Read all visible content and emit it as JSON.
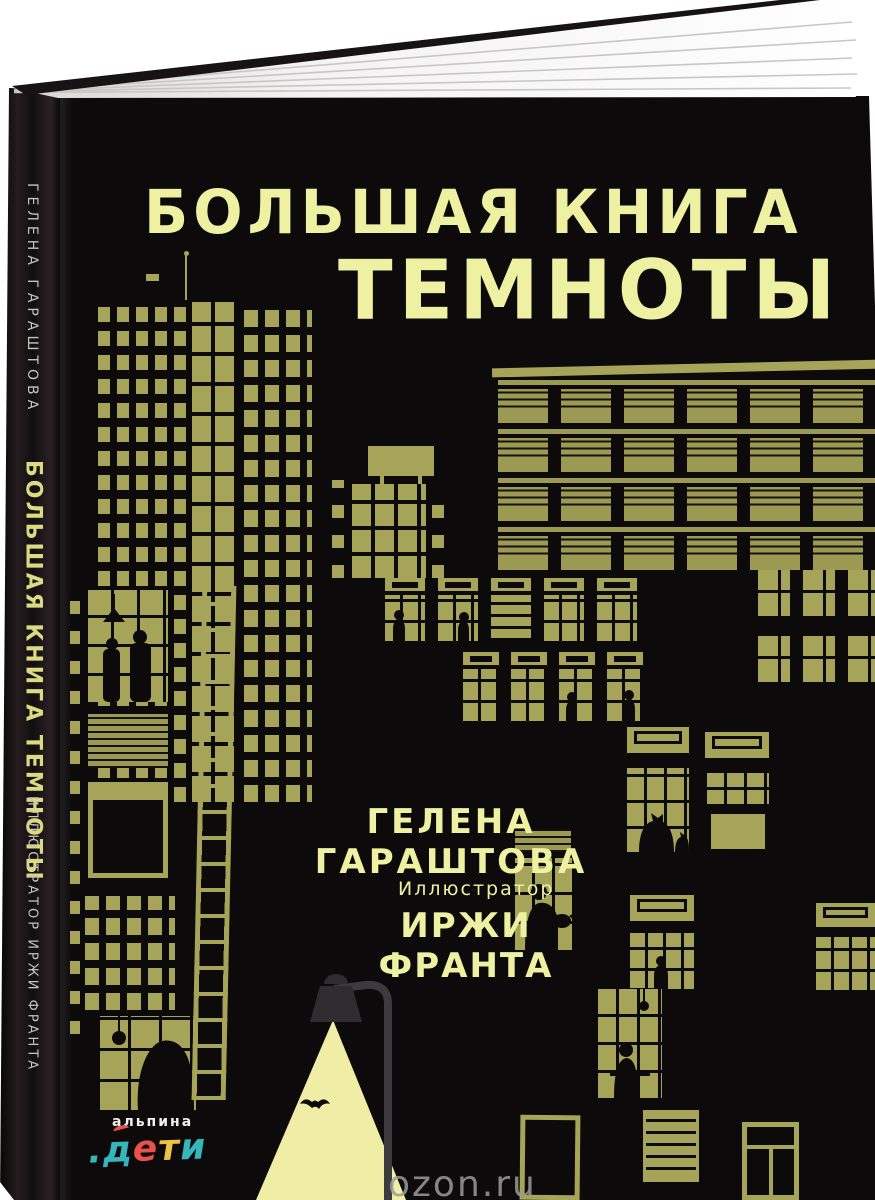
{
  "cover": {
    "title_line1": "БОЛЬШАЯ КНИГА",
    "title_line2": "ТЕМНОТЫ",
    "author": "ГЕЛЕНА ГАРАШТОВА",
    "illustrator_label": "Иллюстратор",
    "illustrator_name": "ИРЖИ ФРАНТА",
    "colors": {
      "background": "#0d0a0b",
      "title": "#eef0a2",
      "illustration_olive": "#a6a458",
      "light_beam": "#efeda6"
    }
  },
  "spine": {
    "author": "ГЕЛЕНА ГАРАШТОВА",
    "title": "БОЛЬШАЯ КНИГА ТЕМНОТЫ",
    "illustrator": "ИЛЛЮСТРАТОР ИРЖИ ФРАНТА"
  },
  "publisher": {
    "name": "альпина",
    "word": ".дети",
    "letters": [
      ".",
      "д",
      "е",
      "т",
      "и"
    ],
    "letter_colors": [
      "#35b6bb",
      "#35b6bb",
      "#e8524a",
      "#edc243",
      "#35b6bb"
    ]
  },
  "watermark": {
    "text": "ozon.ru",
    "color": "#9b9b9b"
  },
  "illustration": {
    "style": "night city of black buildings with lit olive-yellow windows",
    "elements": [
      "left-tower-building",
      "billboard",
      "apartment-building",
      "fire-escape-ladder",
      "couple-window",
      "cat-on-sill-window",
      "person-with-cat-window",
      "reading-person-window",
      "desk-window",
      "street-lamp",
      "light-beam",
      "bat"
    ]
  }
}
